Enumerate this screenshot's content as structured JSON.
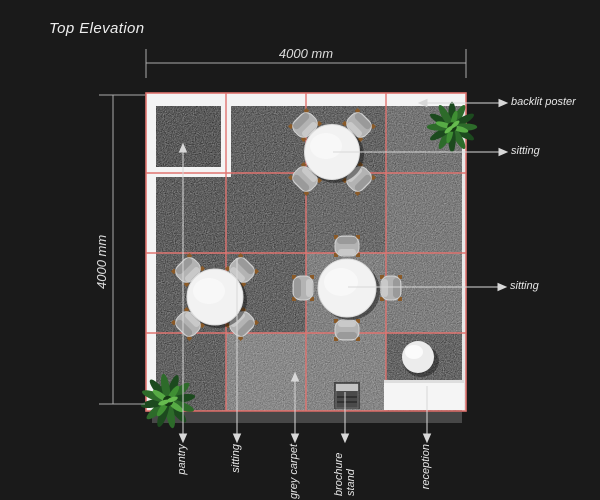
{
  "title": "Top Elevation",
  "dimensions": {
    "width_label": "4000 mm",
    "height_label": "4000 mm"
  },
  "callouts": {
    "backlit_poster": "backlit poster",
    "sitting_top": "sitting",
    "sitting_right": "sitting",
    "pantry": "pantry",
    "sitting_bottom": "sitting",
    "grey_carpet": "grey carpet",
    "brochure_stand": "brochure stand",
    "reception": "reception"
  },
  "colors": {
    "background": "#1a1a1a",
    "grid_line": "#e07470",
    "wall_white": "#f4f4f4",
    "carpet_dark": "#2a2a2a",
    "carpet_light": "#565656",
    "table_white": "#f2f2f2",
    "chair_grey": "#b3b3b3",
    "plant_green": "#3f8f33",
    "annotation_line": "#d8d8d8"
  }
}
